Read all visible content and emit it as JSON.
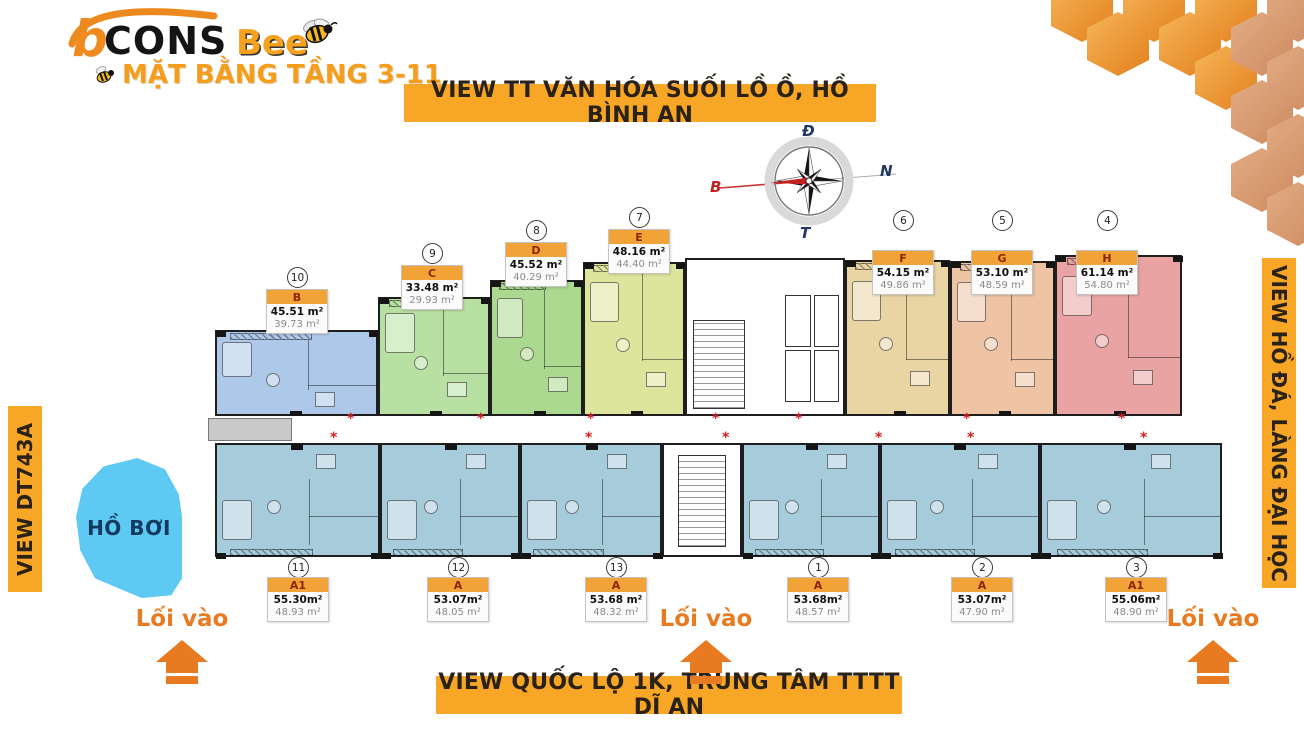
{
  "logo": {
    "brand_prefix": "b",
    "brand_main": "CONS",
    "brand_accent": "Bee",
    "subtitle": "MẶT BẰNG TẦNG 3-11"
  },
  "banners": {
    "top": "VIEW TT VĂN HÓA SUỐI LỒ Ồ, HỒ BÌNH AN",
    "right": "VIEW HỒ ĐÁ, LÀNG ĐẠI HỌC",
    "left": "VIEW DT743A",
    "bottom": "VIEW QUỐC LỘ 1K, TRUNG TÂM TTTT DĨ AN"
  },
  "compass": {
    "top": "Đ",
    "right": "N",
    "bottom": "T",
    "left": "B"
  },
  "pool": {
    "label": "HỒ BƠI"
  },
  "entrance": {
    "label": "Lối vào",
    "positions_x": [
      182,
      706,
      1213
    ]
  },
  "colors": {
    "banner_bg": "#F7A725",
    "card_header_bg": "#F2A337",
    "entrance_orange": "#E87A22",
    "pool_blue": "#5ec9f2",
    "marker_red": "#d3201f",
    "hex_orange": "#ED8F33",
    "hex_salmon": "#DCA077"
  },
  "units": {
    "top": [
      {
        "no": "10",
        "code": "B",
        "area_construction": "45.51 m²",
        "area_usable": "39.73 m²",
        "cx": 297,
        "circle_cy": 277,
        "card_top": 289,
        "plan": {
          "x": 215,
          "w": 163,
          "top": 330,
          "color": "#adc8e8"
        }
      },
      {
        "no": "9",
        "code": "C",
        "area_construction": "33.48 m²",
        "area_usable": "29.93 m²",
        "cx": 432,
        "circle_cy": 253,
        "card_top": 265,
        "plan": {
          "x": 378,
          "w": 112,
          "top": 297,
          "color": "#b8e0a2"
        }
      },
      {
        "no": "8",
        "code": "D",
        "area_construction": "45.52 m²",
        "area_usable": "40.29 m²",
        "cx": 536,
        "circle_cy": 230,
        "card_top": 242,
        "plan": {
          "x": 490,
          "w": 93,
          "top": 280,
          "color": "#abd98f"
        }
      },
      {
        "no": "7",
        "code": "E",
        "area_construction": "48.16 m²",
        "area_usable": "44.40 m²",
        "cx": 639,
        "circle_cy": 217,
        "card_top": 229,
        "plan": {
          "x": 583,
          "w": 102,
          "top": 262,
          "color": "#dde59c"
        }
      },
      {
        "no": "6",
        "code": "F",
        "area_construction": "54.15 m²",
        "area_usable": "49.86 m²",
        "cx": 903,
        "circle_cy": 220,
        "card_top": 250,
        "plan": {
          "x": 845,
          "w": 105,
          "top": 260,
          "color": "#e9d4a4"
        }
      },
      {
        "no": "5",
        "code": "G",
        "area_construction": "53.10 m²",
        "area_usable": "48.59 m²",
        "cx": 1002,
        "circle_cy": 220,
        "card_top": 250,
        "plan": {
          "x": 950,
          "w": 105,
          "top": 261,
          "color": "#eec4a4"
        }
      },
      {
        "no": "4",
        "code": "H",
        "area_construction": "61.14 m²",
        "area_usable": "54.80 m²",
        "cx": 1107,
        "circle_cy": 220,
        "card_top": 250,
        "plan": {
          "x": 1055,
          "w": 127,
          "top": 255,
          "color": "#e9a3a3"
        }
      }
    ],
    "bottom": [
      {
        "no": "11",
        "code": "A1",
        "area_construction": "55.30m²",
        "area_usable": "48.93 m²",
        "cx": 298,
        "circle_cy": 567,
        "card_top": 577,
        "plan": {
          "x": 215,
          "w": 165,
          "color": "#a6cbdb"
        }
      },
      {
        "no": "12",
        "code": "A",
        "area_construction": "53.07m²",
        "area_usable": "48.05 m²",
        "cx": 458,
        "circle_cy": 567,
        "card_top": 577,
        "plan": {
          "x": 380,
          "w": 140,
          "color": "#a6cbdb"
        }
      },
      {
        "no": "13",
        "code": "A",
        "area_construction": "53.68 m²",
        "area_usable": "48.32 m²",
        "cx": 616,
        "circle_cy": 567,
        "card_top": 577,
        "plan": {
          "x": 520,
          "w": 142,
          "color": "#a6cbdb"
        }
      },
      {
        "no": "1",
        "code": "A",
        "area_construction": "53.68m²",
        "area_usable": "48.57 m²",
        "cx": 818,
        "circle_cy": 567,
        "card_top": 577,
        "plan": {
          "x": 742,
          "w": 138,
          "color": "#a6cbdb"
        }
      },
      {
        "no": "2",
        "code": "A",
        "area_construction": "53.07m²",
        "area_usable": "47.90 m²",
        "cx": 982,
        "circle_cy": 567,
        "card_top": 577,
        "plan": {
          "x": 880,
          "w": 160,
          "color": "#a6cbdb"
        }
      },
      {
        "no": "3",
        "code": "A1",
        "area_construction": "55.06m²",
        "area_usable": "48.90 m²",
        "cx": 1136,
        "circle_cy": 567,
        "card_top": 577,
        "plan": {
          "x": 1040,
          "w": 182,
          "color": "#a6cbdb"
        }
      }
    ]
  },
  "plan_geometry": {
    "top_row_bottom": 416,
    "bottom_row_top": 443,
    "bottom_row_bottom": 557,
    "core_top": {
      "x": 685,
      "w": 160,
      "top": 258
    },
    "core_bottom": {
      "x": 662,
      "w": 80
    },
    "corridor": {
      "x": 205,
      "w": 980,
      "y": 416,
      "h": 27
    },
    "gray_box": {
      "x": 208,
      "w": 84,
      "y": 418,
      "h": 23
    },
    "markers_row1_y": 414,
    "markers_row1_x": [
      347,
      477,
      587,
      712,
      795,
      963,
      1118
    ],
    "markers_row2_y": 433,
    "markers_row2_x": [
      330,
      585,
      722,
      875,
      967,
      1140
    ]
  }
}
